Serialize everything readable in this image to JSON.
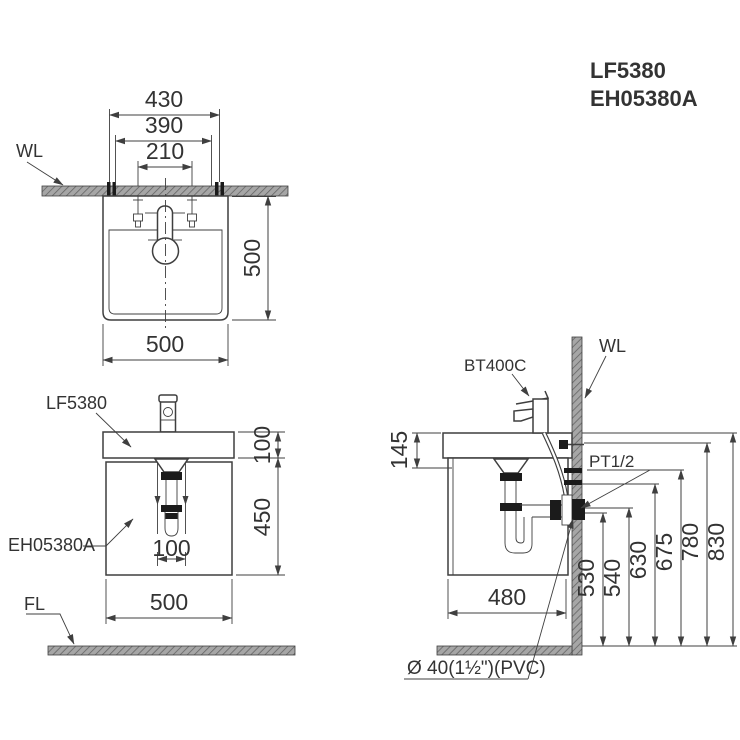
{
  "header": {
    "line1": "LF5380",
    "line2": "EH05380A"
  },
  "front_view": {
    "wall_label": "WL",
    "dim_hanger_width": "430",
    "dim_bracket_width": "390",
    "dim_bolt_spacing": "210",
    "dim_height": "500",
    "dim_width": "500"
  },
  "cabinet_view": {
    "basin_label": "LF5380",
    "cabinet_label": "EH05380A",
    "floor_label": "FL",
    "dim_basin_height": "100",
    "dim_cabinet_height": "450",
    "dim_drain_offset": "100",
    "dim_width": "500"
  },
  "side_view": {
    "faucet_label": "BT400C",
    "wall_label": "WL",
    "supply_label": "PT1/2",
    "drain_label": "Ø 40(1½\")(PVC)",
    "dim_basin_depth": "145",
    "dim_cabinet_depth": "480",
    "heights": [
      "530",
      "540",
      "630",
      "675",
      "780",
      "830"
    ]
  },
  "colors": {
    "line": "#3f3f3f",
    "text": "#333333",
    "hatch_bg": "#a6a6a6",
    "hatch_line": "#646464",
    "black": "#1b1b1b"
  }
}
